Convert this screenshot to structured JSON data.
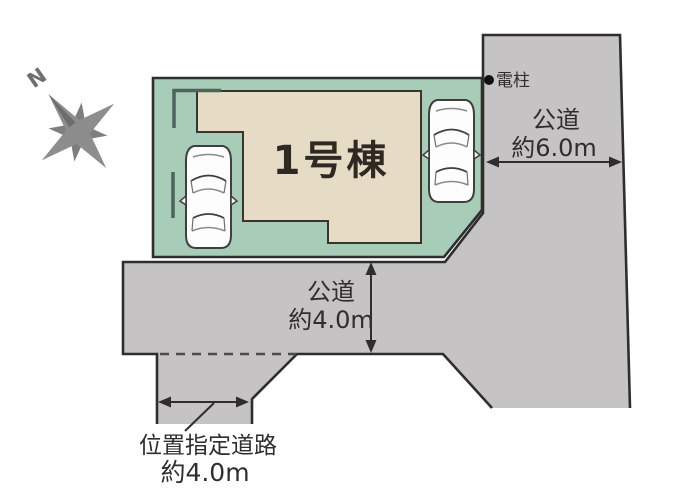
{
  "site_plan": {
    "building_label": "1号棟",
    "compass_label": "N",
    "utility_pole_label": "電柱",
    "roads": {
      "east": {
        "name": "公道",
        "width": "約6.0m"
      },
      "south": {
        "name": "公道",
        "width": "約4.0m"
      },
      "designated": {
        "name": "位置指定道路",
        "width": "約4.0m"
      }
    },
    "colors": {
      "lot_green": "#a7cdb9",
      "building_beige": "#e6dcc5",
      "road_gray": "#c5c3c3",
      "outline_dark": "#2e2e2e",
      "wall_mark": "#4e635a",
      "compass_gray": "#8d8d8d",
      "pole_dot": "#111111",
      "car_body": "#fdfdfd"
    }
  }
}
